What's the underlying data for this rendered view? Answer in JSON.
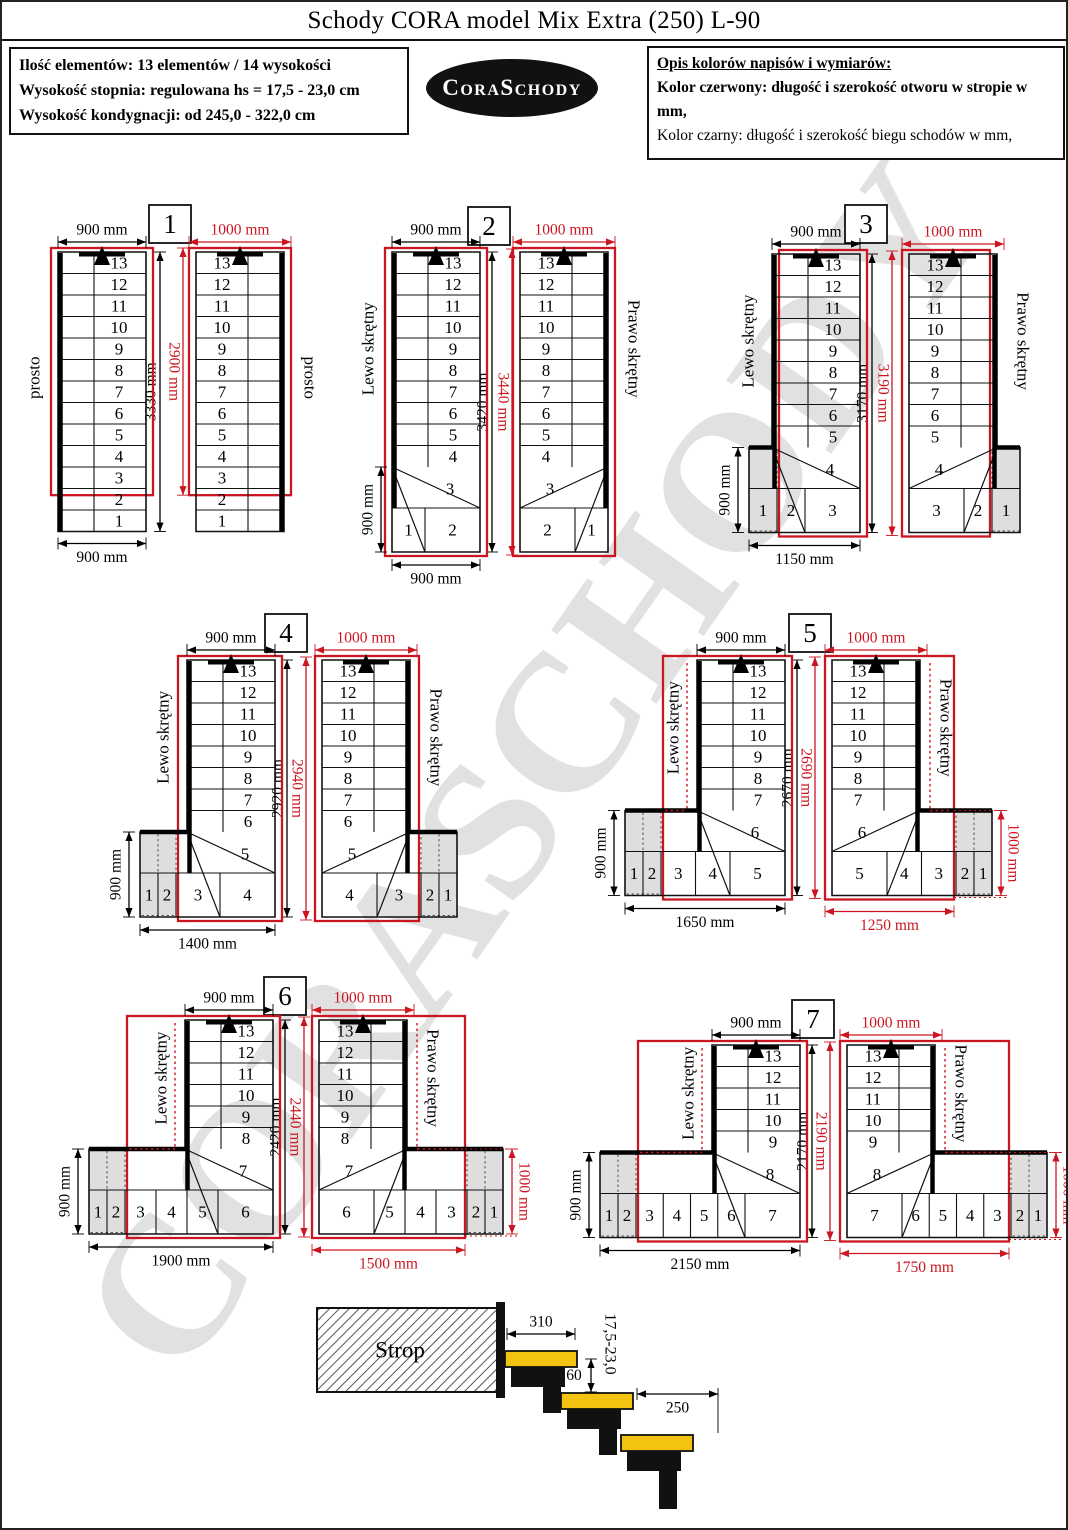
{
  "title": "Schody CORA model Mix Extra (250) L-90",
  "info_box": {
    "line1": "Ilość elementów: 13 elementów / 14 wysokości",
    "line2": "Wysokość stopnia: regulowana  hs = 17,5 - 23,0 cm",
    "line3": "Wysokość kondygnacji: od 245,0 - 322,0 cm"
  },
  "logo_text": "CoraSchody",
  "legend": {
    "heading": "Opis kolorów napisów i wymiarów:",
    "red_line": "Kolor czerwony: długość i szerokość otworu w stropie w mm,",
    "black_line": "Kolor czarny: długość i szerokość biegu schodów w mm,"
  },
  "watermark_text": "CORASCHODY",
  "colors": {
    "red": "#cb1621",
    "black": "#000000",
    "gray_fill": "#dedede",
    "yellow": "#f2c411",
    "watermark": "#c9c9c9"
  },
  "diagrams": [
    {
      "number": "1",
      "left_label": "prosto",
      "right_label": "prosto",
      "top_dim_black": "900 mm",
      "top_dim_red": "1000 mm",
      "height_dim_black": "3330 mm",
      "height_dim_red": "2900 mm",
      "bottom_dim_black": "900 mm",
      "side_dim_black": "",
      "bottom_dim_red": "",
      "side_dim_red": "",
      "flight_steps": [
        "13",
        "12",
        "11",
        "10",
        "9",
        "8",
        "7",
        "6",
        "5",
        "4",
        "3",
        "2",
        "1"
      ],
      "transition_step": "",
      "bottom_steps": [],
      "gray_count": 0
    },
    {
      "number": "2",
      "left_label": "Lewo skrętny",
      "right_label": "Prawo skrętny",
      "top_dim_black": "900 mm",
      "top_dim_red": "1000 mm",
      "height_dim_black": "3420 mm",
      "height_dim_red": "3440 mm",
      "bottom_dim_black": "900 mm",
      "side_dim_black": "900 mm",
      "bottom_dim_red": "",
      "side_dim_red": "",
      "flight_steps": [
        "13",
        "12",
        "11",
        "10",
        "9",
        "8",
        "7",
        "6",
        "5",
        "4"
      ],
      "transition_step": "3",
      "bottom_steps": [
        "1",
        "2"
      ],
      "gray_count": 0
    },
    {
      "number": "3",
      "left_label": "Lewo skrętny",
      "right_label": "Prawo skrętny",
      "top_dim_black": "900 mm",
      "top_dim_red": "1000 mm",
      "height_dim_black": "3170 mm",
      "height_dim_red": "3190 mm",
      "bottom_dim_black": "1150 mm",
      "side_dim_black": "900 mm",
      "bottom_dim_red": "",
      "side_dim_red": "",
      "flight_steps": [
        "13",
        "12",
        "11",
        "10",
        "9",
        "8",
        "7",
        "6",
        "5"
      ],
      "transition_step": "4",
      "bottom_steps": [
        "1",
        "2",
        "3"
      ],
      "gray_count": 1
    },
    {
      "number": "4",
      "left_label": "Lewo skrętny",
      "right_label": "Prawo skrętny",
      "top_dim_black": "900 mm",
      "top_dim_red": "1000 mm",
      "height_dim_black": "2920 mm",
      "height_dim_red": "2940 mm",
      "bottom_dim_black": "1400 mm",
      "side_dim_black": "900 mm",
      "bottom_dim_red": "",
      "side_dim_red": "",
      "flight_steps": [
        "13",
        "12",
        "11",
        "10",
        "9",
        "8",
        "7",
        "6"
      ],
      "transition_step": "5",
      "bottom_steps": [
        "1",
        "2",
        "3",
        "4"
      ],
      "gray_count": 2
    },
    {
      "number": "5",
      "left_label": "Lewo skrętny",
      "right_label": "Prawo skrętny",
      "top_dim_black": "900 mm",
      "top_dim_red": "1000 mm",
      "height_dim_black": "2670 mm",
      "height_dim_red": "2690 mm",
      "bottom_dim_black": "1650 mm",
      "side_dim_black": "900 mm",
      "bottom_dim_red": "1250 mm",
      "side_dim_red": "1000 mm",
      "flight_steps": [
        "13",
        "12",
        "11",
        "10",
        "9",
        "8",
        "7"
      ],
      "transition_step": "6",
      "bottom_steps": [
        "1",
        "2",
        "3",
        "4",
        "5"
      ],
      "gray_count": 2
    },
    {
      "number": "6",
      "left_label": "Lewo skrętny",
      "right_label": "Prawo skrętny",
      "top_dim_black": "900 mm",
      "top_dim_red": "1000 mm",
      "height_dim_black": "2420 mm",
      "height_dim_red": "2440 mm",
      "bottom_dim_black": "1900 mm",
      "side_dim_black": "900 mm",
      "bottom_dim_red": "1500 mm",
      "side_dim_red": "1000 mm",
      "flight_steps": [
        "13",
        "12",
        "11",
        "10",
        "9",
        "8"
      ],
      "transition_step": "7",
      "bottom_steps": [
        "1",
        "2",
        "3",
        "4",
        "5",
        "6"
      ],
      "gray_count": 2
    },
    {
      "number": "7",
      "left_label": "Lewo skrętny",
      "right_label": "Prawo skrętny",
      "top_dim_black": "900 mm",
      "top_dim_red": "1000 mm",
      "height_dim_black": "2170 mm",
      "height_dim_red": "2190 mm",
      "bottom_dim_black": "2150 mm",
      "side_dim_black": "900 mm",
      "bottom_dim_red": "1750 mm",
      "side_dim_red": "1000 mm",
      "flight_steps": [
        "13",
        "12",
        "11",
        "10",
        "9"
      ],
      "transition_step": "8",
      "bottom_steps": [
        "1",
        "2",
        "3",
        "4",
        "5",
        "6",
        "7"
      ],
      "gray_count": 2
    }
  ],
  "cross_section": {
    "strop_label": "Strop",
    "tread_dim": "310",
    "nosing_dim": "60",
    "depth_dim": "250",
    "riser_range_dim": "17,5-23,0"
  }
}
